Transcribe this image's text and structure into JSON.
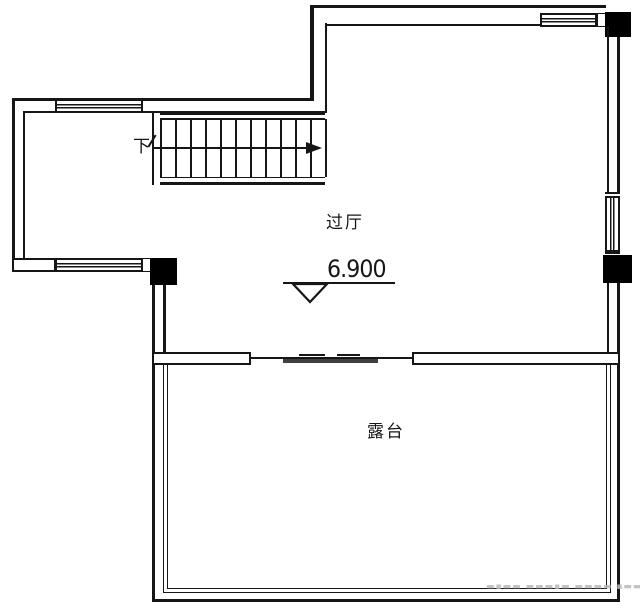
{
  "plan": {
    "labels": {
      "down": "下",
      "hall": "过厅",
      "elevation": "6.900",
      "terrace": "露台"
    },
    "watermark": "▬▪▬▬ ▬▬▬▪▬ ▬▬▬▬ ▪▬▬",
    "stairs": {
      "count": 12,
      "x0": 160,
      "dx": 15,
      "y": 119,
      "h": 58,
      "w": 1.8
    },
    "colors": {
      "line": "#161616",
      "background": "#ffffff",
      "column_fill": "#000000",
      "door_panel": "#3f3f3f",
      "watermark": "#b9b9b9"
    }
  }
}
